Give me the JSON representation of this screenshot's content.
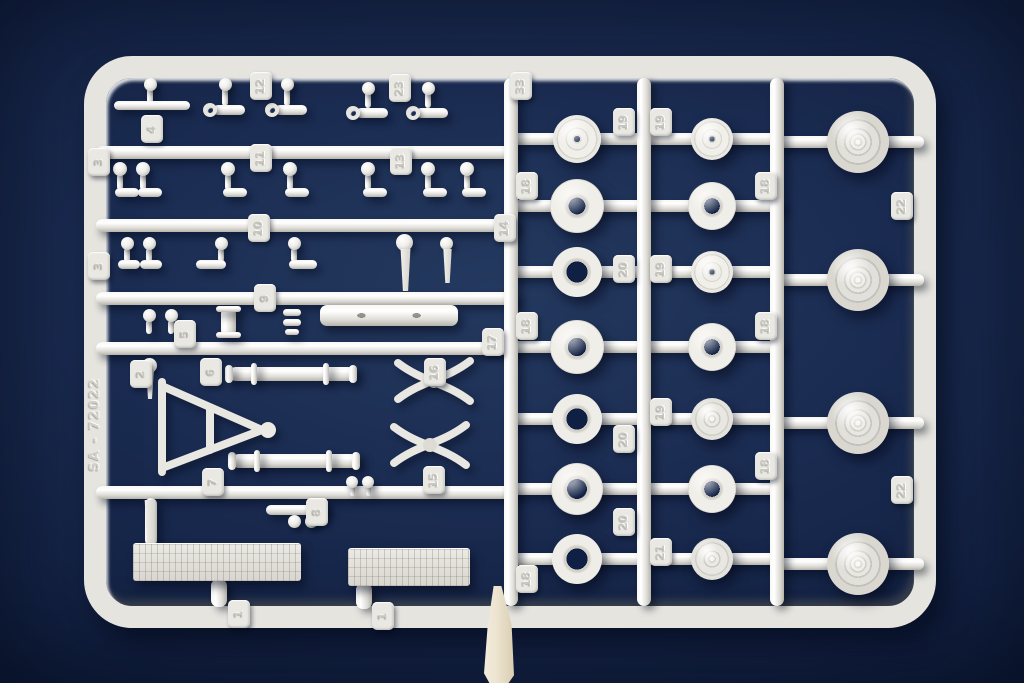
{
  "photo": {
    "subject": "injection-molded model kit sprue with parts",
    "sprue_code": "SA - 72022",
    "colors": {
      "background_navy": "#15264b",
      "hole_navy": "#102044",
      "plastic_light": "#f2f1ec",
      "plastic_shadow": "#b5b3ac",
      "gate_stub_cream": "#e9e0ca"
    },
    "frame": {
      "x": 84,
      "y": 56,
      "w": 852,
      "h": 572,
      "border": 22,
      "radius": 48
    },
    "runners_horizontal": [
      [
        96,
        146,
        518,
        13
      ],
      [
        96,
        219,
        518,
        13
      ],
      [
        96,
        292,
        518,
        13
      ],
      [
        96,
        342,
        518,
        13
      ],
      [
        96,
        486,
        518,
        13
      ],
      [
        505,
        133,
        784,
        12
      ],
      [
        505,
        200,
        784,
        12
      ],
      [
        505,
        266,
        784,
        12
      ],
      [
        505,
        341,
        784,
        12
      ],
      [
        505,
        413,
        784,
        12
      ],
      [
        505,
        483,
        784,
        12
      ],
      [
        505,
        553,
        784,
        12
      ],
      [
        777,
        136,
        924,
        12
      ],
      [
        777,
        274,
        924,
        12
      ],
      [
        777,
        417,
        924,
        12
      ],
      [
        777,
        558,
        924,
        12
      ]
    ],
    "runners_vertical": [
      [
        504,
        78,
        606,
        14
      ],
      [
        637,
        78,
        606,
        14
      ],
      [
        770,
        78,
        606,
        14
      ]
    ],
    "tags": [
      [
        "12",
        250,
        72
      ],
      [
        "23",
        389,
        74
      ],
      [
        "33",
        510,
        72
      ],
      [
        "4",
        141,
        115
      ],
      [
        "3",
        88,
        148
      ],
      [
        "11",
        250,
        144
      ],
      [
        "13",
        390,
        147
      ],
      [
        "3",
        88,
        252
      ],
      [
        "10",
        248,
        214
      ],
      [
        "14",
        494,
        214
      ],
      [
        "9",
        254,
        284
      ],
      [
        "5",
        174,
        320
      ],
      [
        "2",
        130,
        360
      ],
      [
        "6",
        200,
        358
      ],
      [
        "16",
        424,
        358
      ],
      [
        "17",
        482,
        328
      ],
      [
        "15",
        423,
        466
      ],
      [
        "7",
        202,
        468
      ],
      [
        "8",
        306,
        498
      ],
      [
        "1",
        228,
        600
      ],
      [
        "1",
        372,
        602
      ],
      [
        "18",
        516,
        172
      ],
      [
        "18",
        516,
        312
      ],
      [
        "18",
        516,
        565
      ],
      [
        "19",
        613,
        108
      ],
      [
        "19",
        650,
        108
      ],
      [
        "20",
        613,
        255
      ],
      [
        "19",
        650,
        255
      ],
      [
        "19",
        650,
        398
      ],
      [
        "20",
        613,
        425
      ],
      [
        "20",
        613,
        508
      ],
      [
        "21",
        650,
        538
      ],
      [
        "18",
        755,
        172
      ],
      [
        "18",
        755,
        312
      ],
      [
        "18",
        755,
        452
      ],
      [
        "22",
        891,
        192
      ],
      [
        "22",
        891,
        476
      ]
    ],
    "wheels": [
      [
        "disc-hole",
        577,
        139,
        24,
        0
      ],
      [
        "tire",
        577,
        206,
        27,
        12
      ],
      [
        "ring",
        577,
        272,
        25,
        15
      ],
      [
        "tire",
        577,
        347,
        27,
        13
      ],
      [
        "ring",
        577,
        419,
        25,
        15
      ],
      [
        "tire",
        577,
        489,
        26,
        14
      ],
      [
        "ring",
        577,
        559,
        25,
        15
      ],
      [
        "disc-hole",
        712,
        139,
        21,
        0
      ],
      [
        "tire",
        712,
        206,
        24,
        11
      ],
      [
        "disc-hole",
        712,
        272,
        21,
        0
      ],
      [
        "tire",
        712,
        347,
        24,
        11
      ],
      [
        "disc-hub",
        712,
        419,
        21,
        0
      ],
      [
        "tire",
        712,
        489,
        24,
        11
      ],
      [
        "disc-hub",
        712,
        559,
        21,
        0
      ],
      [
        "wheel-full",
        858,
        142,
        31,
        0
      ],
      [
        "wheel-full",
        858,
        280,
        31,
        0
      ],
      [
        "wheel-full",
        858,
        423,
        31,
        0
      ],
      [
        "wheel-full",
        858,
        564,
        31,
        0
      ]
    ],
    "parts": [
      [
        "ball",
        144,
        78,
        13,
        13
      ],
      [
        "vbar",
        147,
        88,
        6,
        16
      ],
      [
        "hbar",
        114,
        101,
        76,
        9
      ],
      [
        "ball",
        219,
        78,
        13,
        13
      ],
      [
        "vbar",
        222,
        88,
        6,
        18
      ],
      [
        "ring",
        203,
        103,
        14,
        14
      ],
      [
        "hbar",
        213,
        105,
        32,
        10
      ],
      [
        "ball",
        281,
        78,
        13,
        13
      ],
      [
        "vbar",
        284,
        88,
        6,
        18
      ],
      [
        "ring",
        265,
        103,
        14,
        14
      ],
      [
        "hbar",
        275,
        105,
        32,
        10
      ],
      [
        "ball",
        362,
        82,
        13,
        13
      ],
      [
        "vbar",
        365,
        92,
        6,
        16
      ],
      [
        "ring",
        346,
        106,
        14,
        14
      ],
      [
        "hbar",
        356,
        108,
        32,
        10
      ],
      [
        "ball",
        422,
        82,
        13,
        13
      ],
      [
        "vbar",
        425,
        92,
        6,
        16
      ],
      [
        "ring",
        406,
        106,
        14,
        14
      ],
      [
        "hbar",
        416,
        108,
        32,
        10
      ],
      [
        "ball",
        113,
        162,
        14,
        14
      ],
      [
        "vbar",
        117,
        174,
        6,
        16
      ],
      [
        "hbar",
        115,
        188,
        24,
        9
      ],
      [
        "ball",
        136,
        162,
        14,
        14
      ],
      [
        "vbar",
        140,
        174,
        6,
        16
      ],
      [
        "hbar",
        138,
        188,
        24,
        9
      ],
      [
        "ball",
        221,
        162,
        14,
        14
      ],
      [
        "vbar",
        225,
        174,
        6,
        16
      ],
      [
        "hbar",
        223,
        188,
        24,
        9
      ],
      [
        "ball",
        283,
        162,
        14,
        14
      ],
      [
        "vbar",
        287,
        174,
        6,
        16
      ],
      [
        "hbar",
        285,
        188,
        24,
        9
      ],
      [
        "ball",
        361,
        162,
        14,
        14
      ],
      [
        "vbar",
        365,
        174,
        6,
        16
      ],
      [
        "hbar",
        363,
        188,
        24,
        9
      ],
      [
        "ball",
        421,
        162,
        14,
        14
      ],
      [
        "vbar",
        425,
        174,
        6,
        16
      ],
      [
        "hbar",
        423,
        188,
        24,
        9
      ],
      [
        "ball",
        460,
        162,
        14,
        14
      ],
      [
        "vbar",
        464,
        174,
        6,
        16
      ],
      [
        "hbar",
        462,
        188,
        24,
        9
      ],
      [
        "ball",
        121,
        237,
        13,
        13
      ],
      [
        "vbar",
        124,
        248,
        6,
        14
      ],
      [
        "hbar",
        118,
        260,
        22,
        9
      ],
      [
        "ball",
        143,
        237,
        13,
        13
      ],
      [
        "vbar",
        146,
        248,
        6,
        14
      ],
      [
        "hbar",
        140,
        260,
        22,
        9
      ],
      [
        "ball",
        215,
        237,
        13,
        13
      ],
      [
        "vbar",
        218,
        248,
        6,
        14
      ],
      [
        "hbar",
        196,
        260,
        30,
        9
      ],
      [
        "ball",
        288,
        237,
        13,
        13
      ],
      [
        "vbar",
        291,
        248,
        6,
        14
      ],
      [
        "hbar",
        289,
        260,
        28,
        9
      ],
      [
        "ball",
        396,
        234,
        17,
        17
      ],
      [
        "pawn",
        399,
        249,
        13,
        42
      ],
      [
        "ball",
        440,
        237,
        13,
        13
      ],
      [
        "pawn",
        442,
        249,
        11,
        34
      ],
      [
        "ball",
        143,
        309,
        13,
        13
      ],
      [
        "vbar",
        146,
        320,
        6,
        14
      ],
      [
        "ball",
        165,
        309,
        13,
        13
      ],
      [
        "vbar",
        168,
        320,
        6,
        14
      ],
      [
        "vbar",
        221,
        307,
        15,
        30
      ],
      [
        "hbar",
        216,
        306,
        25,
        6
      ],
      [
        "hbar",
        216,
        332,
        25,
        6
      ],
      [
        "hbar",
        283,
        309,
        18,
        7
      ],
      [
        "hbar",
        283,
        319,
        18,
        7
      ],
      [
        "hbar",
        285,
        329,
        14,
        6
      ],
      [
        "beam",
        320,
        305,
        138,
        21
      ],
      [
        "ball",
        142,
        358,
        15,
        15
      ],
      [
        "pawn",
        145,
        371,
        10,
        28
      ],
      [
        "aframe",
        152,
        378,
        128,
        98
      ],
      [
        "hbar",
        229,
        367,
        126,
        14
      ],
      [
        "vbar",
        251,
        363,
        6,
        22
      ],
      [
        "vbar",
        323,
        363,
        6,
        22
      ],
      [
        "vbar",
        225,
        365,
        8,
        18
      ],
      [
        "vbar",
        349,
        365,
        8,
        18
      ],
      [
        "xspring",
        393,
        354,
        82,
        54
      ],
      [
        "xspring",
        389,
        418,
        82,
        54
      ],
      [
        "hbar",
        232,
        454,
        126,
        14
      ],
      [
        "vbar",
        254,
        450,
        6,
        22
      ],
      [
        "vbar",
        326,
        450,
        6,
        22
      ],
      [
        "vbar",
        228,
        452,
        8,
        18
      ],
      [
        "vbar",
        352,
        452,
        8,
        18
      ],
      [
        "pawn",
        143,
        500,
        14,
        48
      ],
      [
        "hbar",
        266,
        505,
        58,
        10
      ],
      [
        "vbar",
        317,
        502,
        11,
        15
      ],
      [
        "ball",
        288,
        515,
        13,
        13
      ],
      [
        "ball",
        305,
        515,
        13,
        13
      ],
      [
        "ball",
        346,
        476,
        12,
        12
      ],
      [
        "vbar",
        350,
        486,
        5,
        10
      ],
      [
        "ball",
        362,
        476,
        12,
        12
      ],
      [
        "vbar",
        366,
        486,
        5,
        10
      ],
      [
        "vbar",
        145,
        498,
        12,
        48
      ],
      [
        "grille",
        133,
        543,
        168,
        38
      ],
      [
        "grille",
        348,
        548,
        122,
        38
      ],
      [
        "vbar",
        211,
        579,
        16,
        28
      ],
      [
        "vbar",
        356,
        583,
        16,
        26
      ]
    ]
  }
}
